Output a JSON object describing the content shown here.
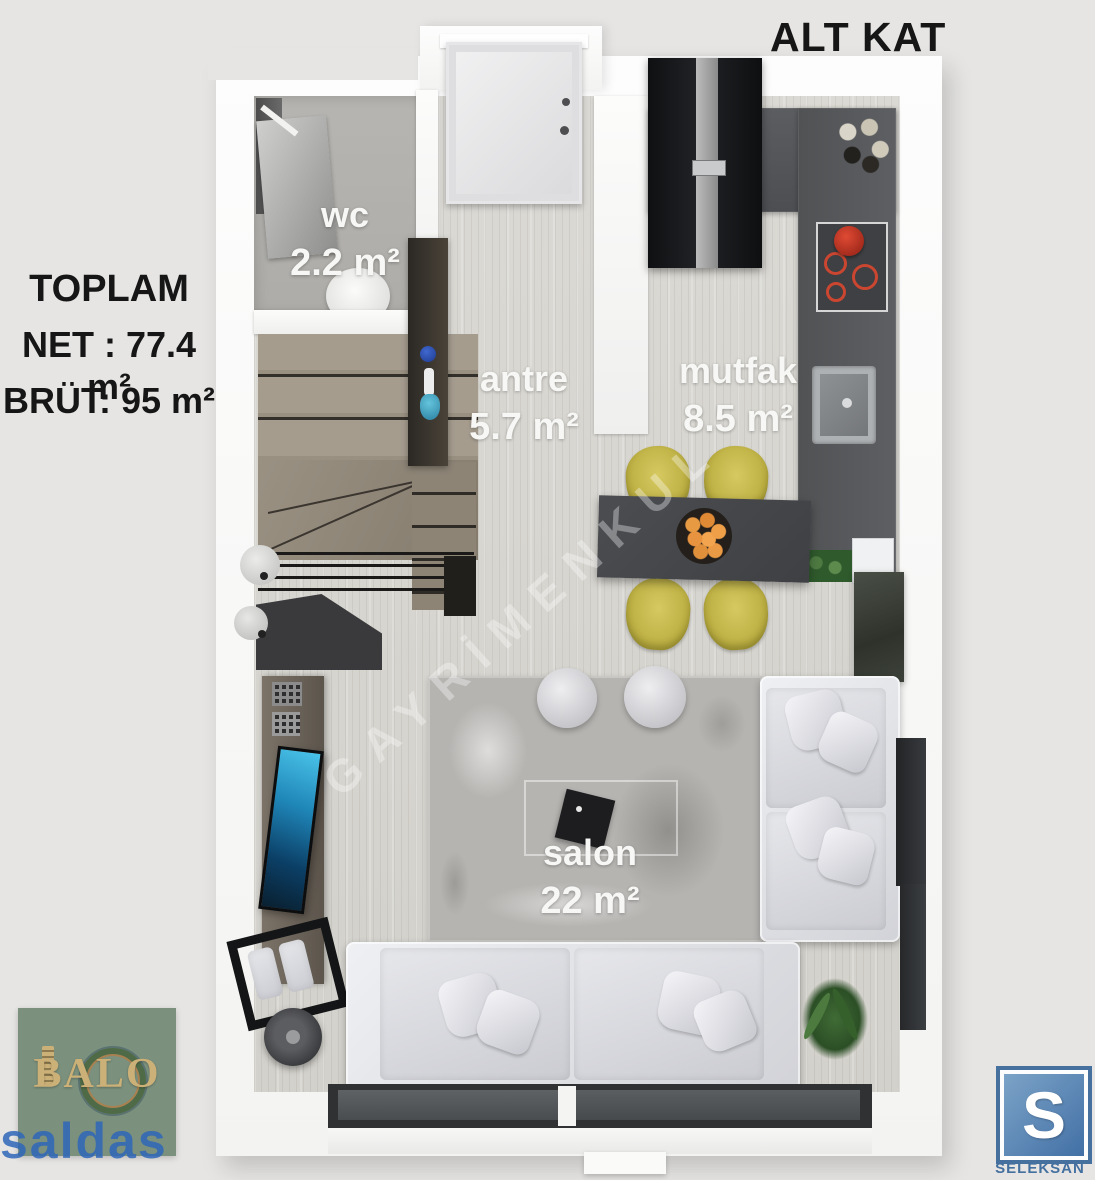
{
  "title": "ALT KAT",
  "summary": {
    "heading": "TOPLAM",
    "net": "NET : 77.4 m²",
    "brut": "BRÜT: 95 m²"
  },
  "rooms": [
    {
      "name": "wc",
      "area": "2.2 m²"
    },
    {
      "name": "antre",
      "area": "5.7 m²"
    },
    {
      "name": "mutfak",
      "area": "8.5 m²"
    },
    {
      "name": "salon",
      "area": "22 m²"
    }
  ],
  "watermark": "GAYRİMENKUL",
  "logos": {
    "balo": {
      "title": "BALO",
      "subtitle": "saldas"
    },
    "seleksan": {
      "letter": "S",
      "label": "SELEKSAN"
    }
  },
  "colors": {
    "background": "#e6e5e3",
    "counter_dark": "#54565a",
    "chair_olive": "#c3b74a",
    "orange_fruit": "#e8953f",
    "balo_green": "#7b907d",
    "balo_gold": "#cbb077",
    "saldas_blue": "#2f66b9",
    "seleksan_blue": "#4a7ab0",
    "tv_screen_blue": "#1f86b8"
  }
}
